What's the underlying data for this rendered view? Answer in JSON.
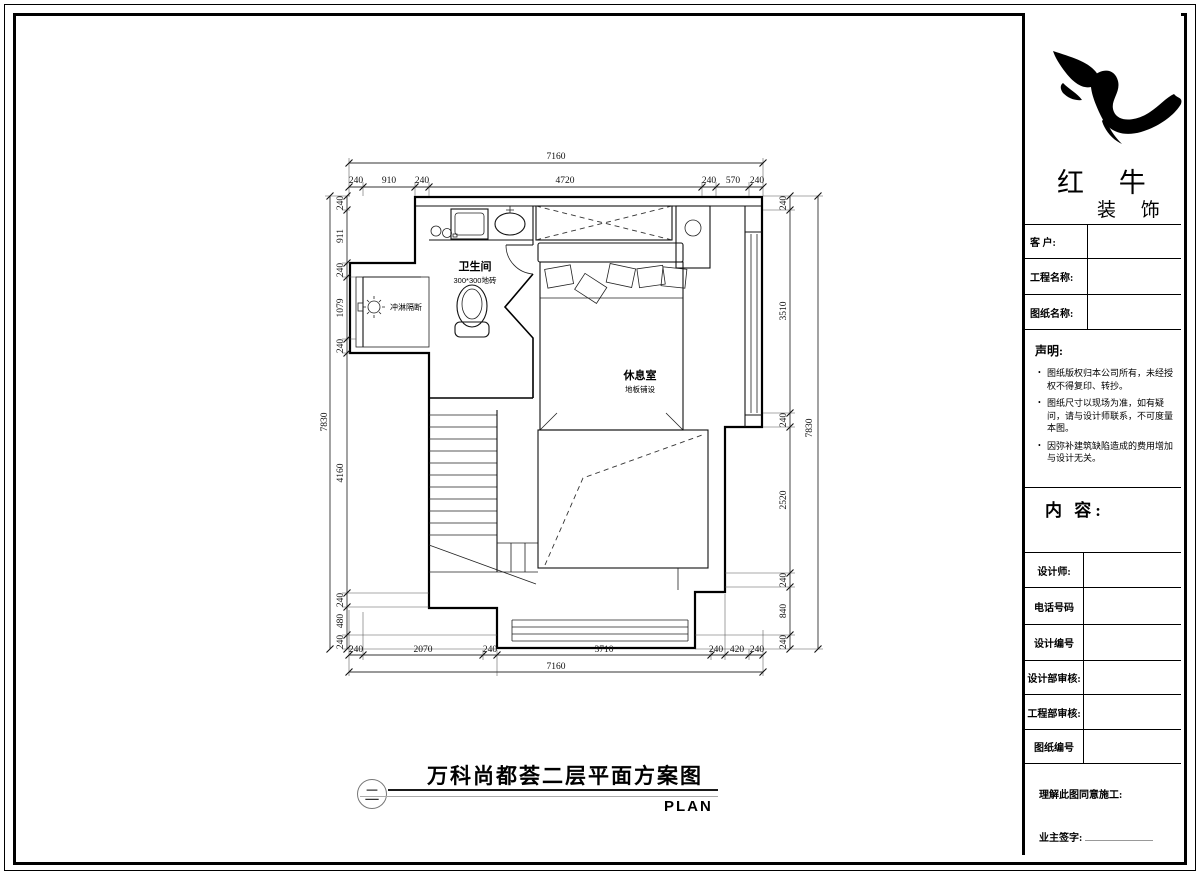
{
  "drawing": {
    "rooms": {
      "bathroom_name": "卫生间",
      "bathroom_note": "300*300地砖",
      "shower_label": "冲淋隔断",
      "lounge_name": "休息室",
      "lounge_note": "地板铺设"
    },
    "dimensions": {
      "top_total": "7160",
      "top_segments": [
        "240",
        "910",
        "240",
        "4720",
        "240",
        "570",
        "240"
      ],
      "bottom_total": "7160",
      "bottom_segments": [
        "240",
        "2070",
        "240",
        "3710",
        "240",
        "420",
        "240"
      ],
      "left_total": "7830",
      "left_segments": [
        "240",
        "911",
        "240",
        "1079",
        "240",
        "4160",
        "240",
        "480",
        "240"
      ],
      "right_total": "7830",
      "right_segments": [
        "240",
        "3510",
        "240",
        "2520",
        "240",
        "840",
        "240"
      ]
    }
  },
  "footer_title": {
    "text": "万科尚都荟二层平面方案图",
    "sheet_number": "二",
    "plan_label": "PLAN"
  },
  "title_block": {
    "brand": {
      "line1": "红 牛",
      "line2": "装 饰"
    },
    "fields_top": [
      {
        "label": "客  户:"
      },
      {
        "label": "工程名称:"
      },
      {
        "label": "图纸名称:"
      }
    ],
    "statement": {
      "heading": "声明:",
      "items": [
        "图纸版权归本公司所有，未经授权不得复印、转抄。",
        "图纸尺寸以现场为准，如有疑问，请与设计师联系，不可度量本图。",
        "因弥补建筑缺陷造成的费用增加与设计无关。"
      ]
    },
    "content_label": "内 容:",
    "fields_bottom": [
      {
        "label": "设计师:"
      },
      {
        "label": "电话号码"
      },
      {
        "label": "设计编号"
      },
      {
        "label": "设计部审核:"
      },
      {
        "label": "工程部审核:"
      },
      {
        "label": "图纸编号"
      }
    ],
    "signoff": {
      "line1": "理解此图同意施工:",
      "line2": "业主签字:"
    }
  }
}
